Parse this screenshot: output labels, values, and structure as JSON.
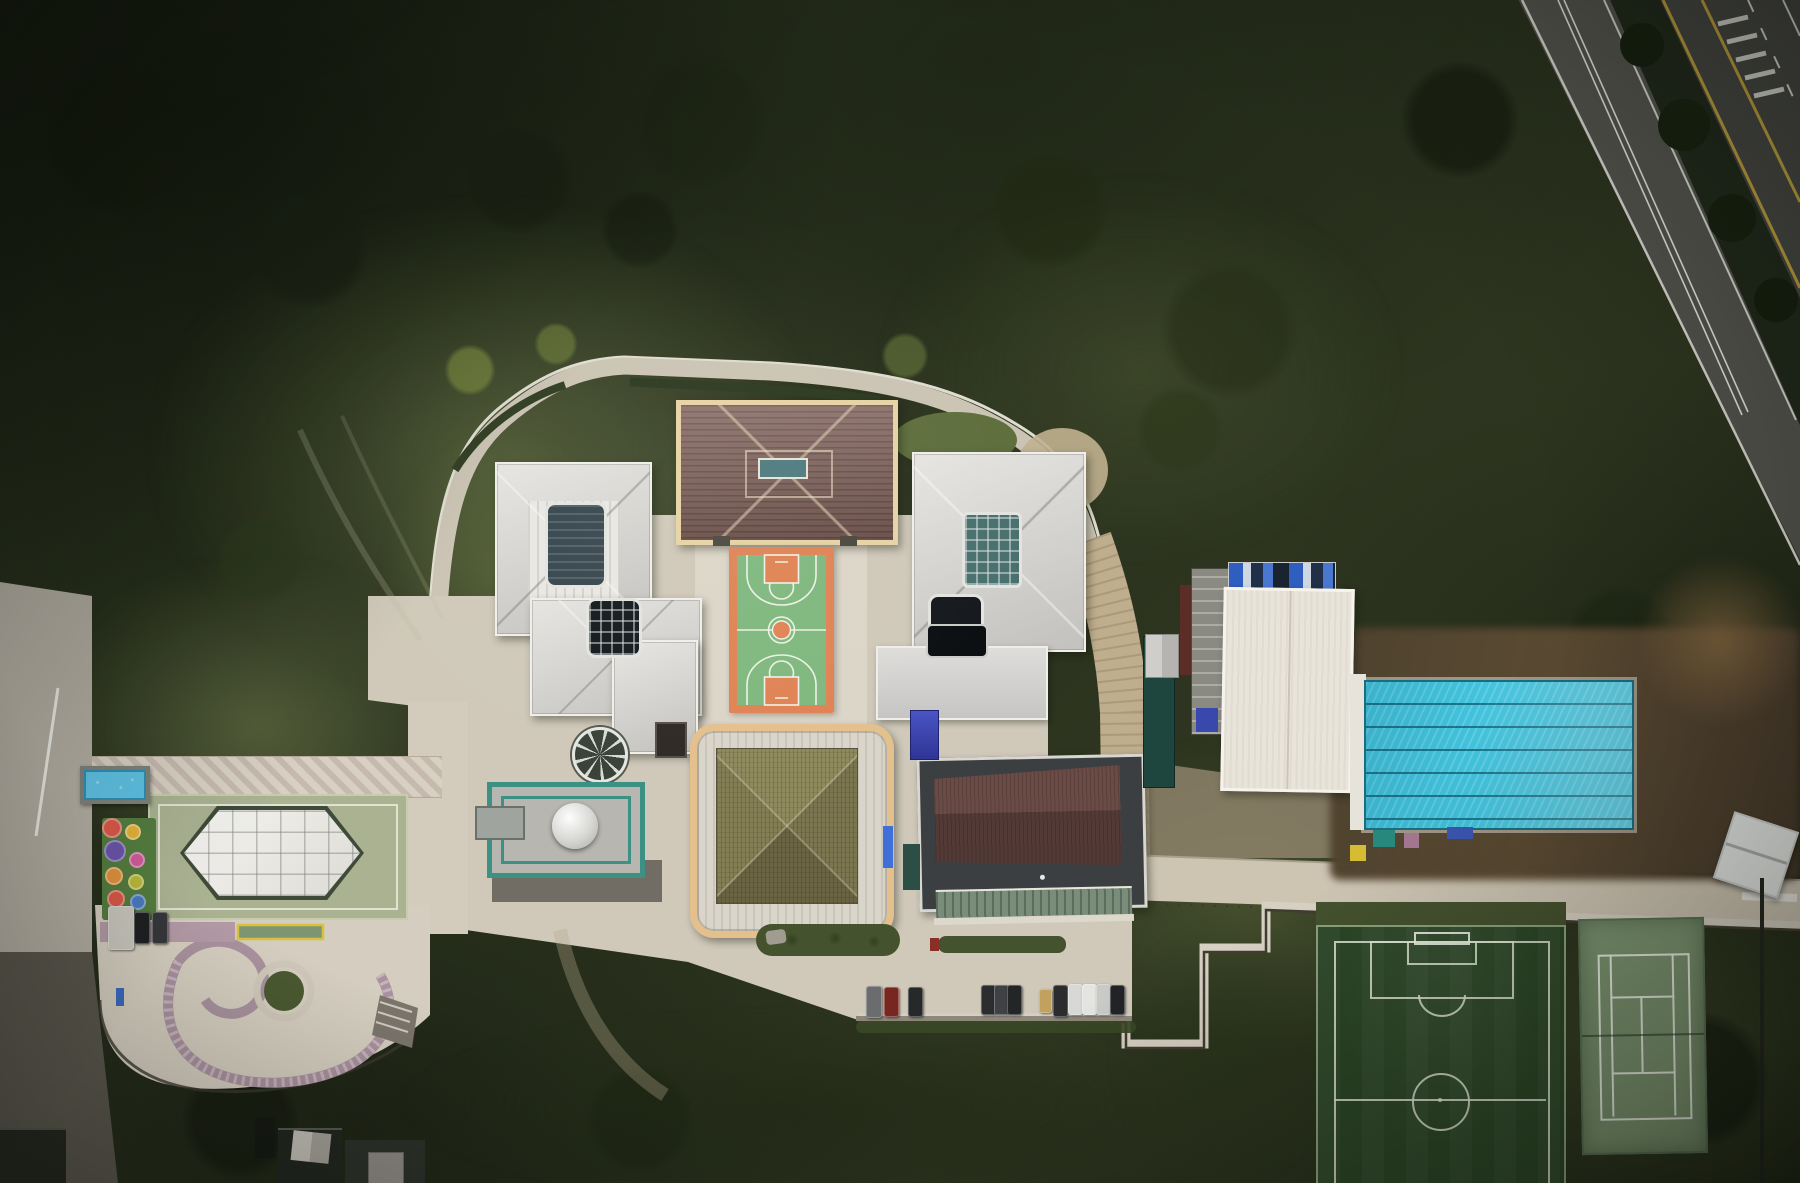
{
  "scene": {
    "description": "Aerial top-down drone photograph of a walled hillside school campus surrounded by dense forest",
    "time_of_day": "overcast daylight",
    "text_visible": "none"
  },
  "palette": {
    "forest_base": "#262e1c",
    "forest_dark": "#1a2113",
    "meadow": "#6c7a4a",
    "plaza": "#d0c9ba",
    "plaza_bright": "#dcd6c9",
    "walkway": "#d8d1c3",
    "mauve": "#a8929e",
    "road_left": "#b3aea3",
    "tan_road": "#bfae8e",
    "asphalt": "#54544e",
    "highway": "#454641",
    "median": "#20281a",
    "yellow_line": "#bfa03c",
    "road_line": "#d9d8d2",
    "roof_gray": "#d6d5d2",
    "roof_trim": "#f0efeb",
    "tile_roof": "#7e5f59",
    "tile_trim": "#e7d3a4",
    "sky_blue": "#4e7a80",
    "khaki_trim": "#e4c08d",
    "maroon": "#5e423e",
    "flat_roof": "#3b3f42",
    "canopy_green": "#7a8d7b",
    "white_roof": "#e9e4da",
    "scaffold": "#8a8a82",
    "tarp_blue": "#2e5fc0",
    "teal_building": "#1e463f",
    "teal_frame": "#3c9184",
    "pool_water": "#41c2dc",
    "pool_lane": "#15657c",
    "deck": "#e6e3db",
    "dirt": "#54452f",
    "dirt_light": "#6b5638",
    "court_green": "#7fb87f",
    "court_orange": "#e08355",
    "line_white": "#eef2e6",
    "field_green": "#2b4526",
    "tennis_green": "#7c9470",
    "tennis_line": "#e9eee2",
    "sage_court": "#aab292",
    "canopy_white": "#eeede9",
    "kiddie_water": "#5fc2e4",
    "playground_green": "#537c3e",
    "hedge": "#44532d",
    "wall_light": "#d6d0c2",
    "gravel": "#716d64",
    "island_green": "#4a5930"
  },
  "features": {
    "forest": {
      "label": "dense forest and scrub hillside"
    },
    "roads": {
      "highway": {
        "label": "divided highway, top-right, yellow edge lines, white dashes, zebra crossing"
      },
      "access_road": {
        "label": "two-lane road with white centerline beside highway"
      },
      "service_road": {
        "label": "light road along left edge with guardrail"
      },
      "perimeter_road": {
        "label": "walled perimeter lane looping around north side of campus"
      }
    },
    "campus": {
      "buildings": [
        {
          "id": "northwest-hall",
          "roof": "light gray hip roof, two dark skylights"
        },
        {
          "id": "north-hall",
          "roof": "red-brown tiled hip roof, cream trim, blue skylight"
        },
        {
          "id": "northeast-hall",
          "roof": "light gray hip roof, teal glass atrium, dark skylight"
        },
        {
          "id": "south-pavilion",
          "roof": "olive pyramidal roof in rounded cream frame"
        },
        {
          "id": "auditorium",
          "roof": "dark maroon roof on dark flat deck with green walkway canopy"
        },
        {
          "id": "gymnasium",
          "roof": "white metal roof, scaffolding and blue tarps (under construction)"
        },
        {
          "id": "dome-pavilion",
          "roof": "teal-framed glass roof with white dome"
        }
      ],
      "basketball_court": {
        "label": "basketball court",
        "surface": "green with orange border, keys and center circle"
      },
      "swimming_pool": {
        "label": "outdoor pool",
        "lane_lines": 6
      },
      "soccer_field": {
        "label": "artificial turf soccer pitch, white markings"
      },
      "tennis_court": {
        "label": "green tennis court, white lines"
      },
      "canopy_court": {
        "label": "sage multi-use court under white hexagonal canopy"
      },
      "kiddie_pool": {
        "label": "small bright blue splash pool"
      },
      "playground": {
        "label": "playground with colorful play rings",
        "dots": [
          [
            110,
            826,
            8,
            "#d85848"
          ],
          [
            131,
            830,
            6,
            "#e2b13c"
          ],
          [
            113,
            849,
            9,
            "#6a55a8"
          ],
          [
            135,
            858,
            6,
            "#cf5a9a"
          ],
          [
            112,
            874,
            7,
            "#e0913c"
          ],
          [
            134,
            880,
            6,
            "#b8b83a"
          ],
          [
            114,
            897,
            7,
            "#d85848"
          ],
          [
            136,
            900,
            6,
            "#4a7ac0"
          ]
        ]
      },
      "parking": {
        "label": "parking bay with parked cars",
        "car_count": 12,
        "cars": [
          [
            866,
            986,
            14,
            30,
            "#6a6c6e"
          ],
          [
            884,
            987,
            13,
            28,
            "#772620"
          ],
          [
            908,
            987,
            13,
            28,
            "#26282a"
          ],
          [
            981,
            985,
            13,
            28,
            "#2b2d2f"
          ],
          [
            994,
            985,
            13,
            28,
            "#3f4144"
          ],
          [
            1007,
            985,
            13,
            28,
            "#232527"
          ],
          [
            1039,
            989,
            11,
            22,
            "#c2a05e"
          ],
          [
            1053,
            985,
            13,
            30,
            "#2a2c2e"
          ],
          [
            1068,
            984,
            13,
            29,
            "#d8d9d6"
          ],
          [
            1082,
            984,
            13,
            29,
            "#e4e4e1"
          ],
          [
            1096,
            984,
            13,
            29,
            "#c9cac7"
          ],
          [
            1110,
            985,
            13,
            28,
            "#212326"
          ]
        ]
      },
      "west_vehicles": {
        "label": "bus and cars parked by playground",
        "cars": [
          [
            108,
            906,
            24,
            42,
            "#c9c6bd"
          ],
          [
            134,
            912,
            14,
            30,
            "#1e2022"
          ],
          [
            152,
            912,
            14,
            30,
            "#35373a"
          ]
        ]
      },
      "pool_deck_items": {
        "label": "equipment on pool deck",
        "items": [
          [
            1373,
            830,
            22,
            17,
            "#27897e"
          ],
          [
            1404,
            833,
            15,
            15,
            "#a57891"
          ],
          [
            1447,
            827,
            26,
            12,
            "#3b55b0"
          ],
          [
            1350,
            845,
            16,
            16,
            "#d4bc35"
          ]
        ]
      },
      "drop_off_loop": {
        "label": "drop-off loop with circular tree island and mauve walkways"
      }
    },
    "tree_blobs": [
      [
        470,
        370,
        26,
        "#78883e",
        0.7
      ],
      [
        556,
        344,
        22,
        "#6e7e3a",
        0.65
      ],
      [
        905,
        356,
        24,
        "#66763a",
        0.6
      ],
      [
        878,
        430,
        20,
        "#5e7038",
        0.6
      ],
      [
        310,
        250,
        60,
        "#1a2113",
        0.7
      ],
      [
        120,
        140,
        80,
        "#161c0e",
        0.75
      ],
      [
        700,
        120,
        70,
        "#1c2313",
        0.6
      ],
      [
        1050,
        210,
        60,
        "#202812",
        0.55
      ],
      [
        1230,
        330,
        70,
        "#242c14",
        0.5
      ],
      [
        520,
        180,
        55,
        "#192012",
        0.65
      ],
      [
        1460,
        120,
        60,
        "#151b0d",
        0.7
      ],
      [
        260,
        560,
        45,
        "#2c3a1e",
        0.6
      ],
      [
        640,
        230,
        40,
        "#161d0f",
        0.6
      ],
      [
        1180,
        430,
        45,
        "#2a3618",
        0.5
      ],
      [
        1620,
        640,
        55,
        "#1b2412",
        0.6
      ],
      [
        240,
        1120,
        60,
        "#151a0f",
        0.7
      ],
      [
        640,
        1120,
        55,
        "#1c2412",
        0.6
      ],
      [
        1700,
        1080,
        70,
        "#141a0e",
        0.7
      ]
    ]
  }
}
